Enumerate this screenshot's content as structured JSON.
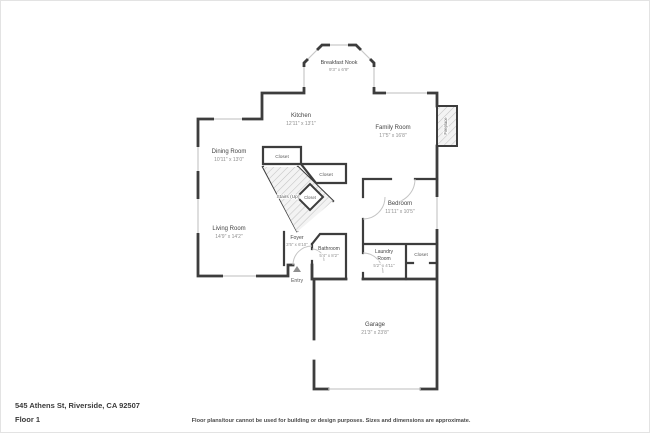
{
  "page": {
    "address": "545 Athens St, Riverside, CA 92507",
    "floor_label": "Floor 1",
    "disclaimer": "Floor plans/tour cannot be used for building or design purposes. Sizes and dimensions are approximate."
  },
  "colors": {
    "wall": "#3d3d3d",
    "room_name": "#454545",
    "room_dim": "#8f8f8f",
    "window": "#c9c9c9",
    "hatch": "#c4c4c4"
  },
  "rooms": {
    "breakfast_nook": {
      "name": "Breakfast Nook",
      "dims": "9'3\" x 6'9\""
    },
    "kitchen": {
      "name": "Kitchen",
      "dims": "12'11\" x 13'1\""
    },
    "family_room": {
      "name": "Family Room",
      "dims": "17'5\" x 16'8\""
    },
    "dining_room": {
      "name": "Dining Room",
      "dims": "10'11\" x 13'0\""
    },
    "living_room": {
      "name": "Living Room",
      "dims": "14'9\" x 14'2\""
    },
    "bedroom": {
      "name": "Bedroom",
      "dims": "11'11\" x 10'5\""
    },
    "foyer": {
      "name": "Foyer",
      "dims": "3'5\" x 6'10\""
    },
    "bathroom": {
      "name": "Bathroom",
      "dims": "5'4\" x 8'2\""
    },
    "laundry_room": {
      "name_line1": "Laundry",
      "name_line2": "Room",
      "dims": "5'2\" x 4'11\""
    },
    "garage": {
      "name": "Garage",
      "dims": "21'3\" x 23'8\""
    },
    "stairs": {
      "name": "Stairs (Up)"
    },
    "closet_upper": {
      "name": "Closet"
    },
    "closet_right": {
      "name": "Closet"
    },
    "closet_mid": {
      "name": "Closet"
    },
    "closet_laundry": {
      "name": "Closet"
    },
    "fireplace": {
      "name": "Fireplace"
    },
    "entry": {
      "name": "Entry"
    }
  }
}
